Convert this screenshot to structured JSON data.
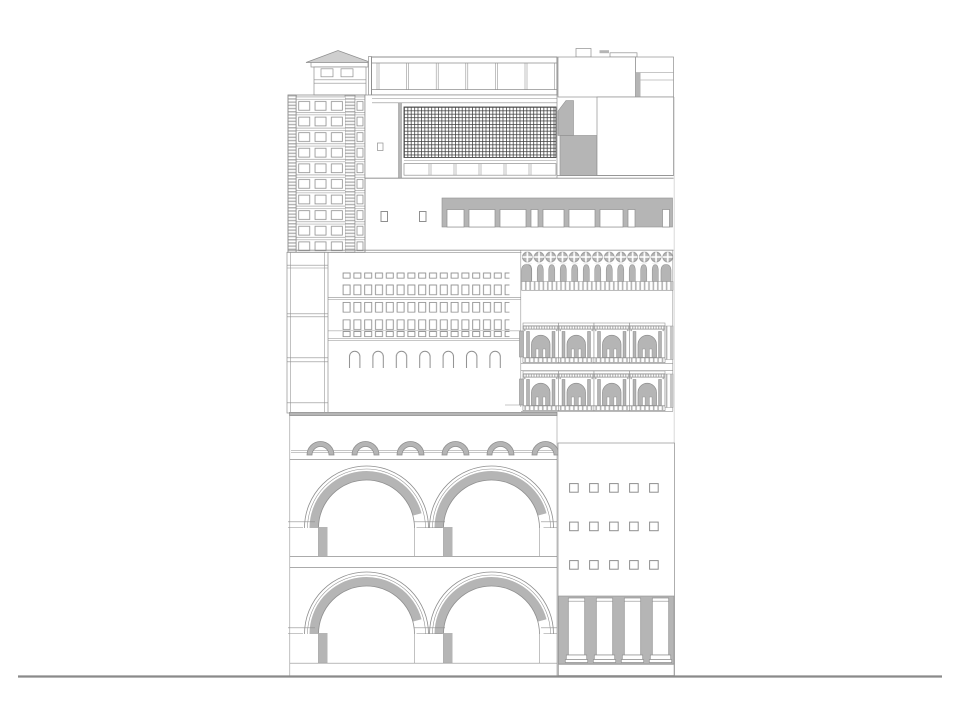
{
  "meta": {
    "kind": "architectural-elevation-collage",
    "description": "Black-and-white composite street elevation made of stacked fragments of different building facades on a single ground line"
  },
  "colors": {
    "bg": "#ffffff",
    "line": "#8f8f8f",
    "line-dark": "#4a4a4a",
    "fill": "#b5b5b5",
    "fill-light": "#cfcfcf",
    "hatch": "#3c3c3c",
    "ground": "#8a8a8a",
    "edge-light": "#d9d9d9"
  },
  "sections": [
    {
      "id": "modern-tower",
      "desc": "high-rise tower with gridded facade and pyramidal rooftop lantern",
      "floors": 10
    },
    {
      "id": "rooftop-glazing-band",
      "desc": "long rooftop skylight band of glazed panels",
      "panels": 6
    },
    {
      "id": "curtain-wall-grid",
      "desc": "dense dark curtain-wall mullion grid with panel row below"
    },
    {
      "id": "upper-right-volumes",
      "desc": "stepped white volumes with grey service blocks"
    },
    {
      "id": "clerestory-band",
      "desc": "grey spandrel band with white window openings",
      "openings": 9,
      "small_windows": 2
    },
    {
      "id": "service-core-strip",
      "desc": "narrow banded service core strip"
    },
    {
      "id": "palazzo-facade",
      "desc": "masonry facade with punched window rows and arched openings",
      "window_columns": 16,
      "window_rows": 5,
      "arched_openings": 7
    },
    {
      "id": "venetian-gothic-loggia",
      "desc": "quatrefoil medallions over a pointed-arch arcade",
      "quatrefoils": 13
    },
    {
      "id": "romanesque-galleries",
      "desc": "two tiers of round-arch classical bays",
      "tiers": 2,
      "bays_per_tier": 4
    },
    {
      "id": "aqueduct",
      "desc": "two tiers of monumental round arches under a small arcade",
      "small_arches": 6,
      "large_arches_per_tier": 2
    },
    {
      "id": "modern-facade-colonnade",
      "desc": "flat facade with square punched windows over a ground-floor colonnade",
      "windows": 15,
      "columns": 4
    },
    {
      "id": "ground-line",
      "desc": "ground datum line"
    }
  ]
}
